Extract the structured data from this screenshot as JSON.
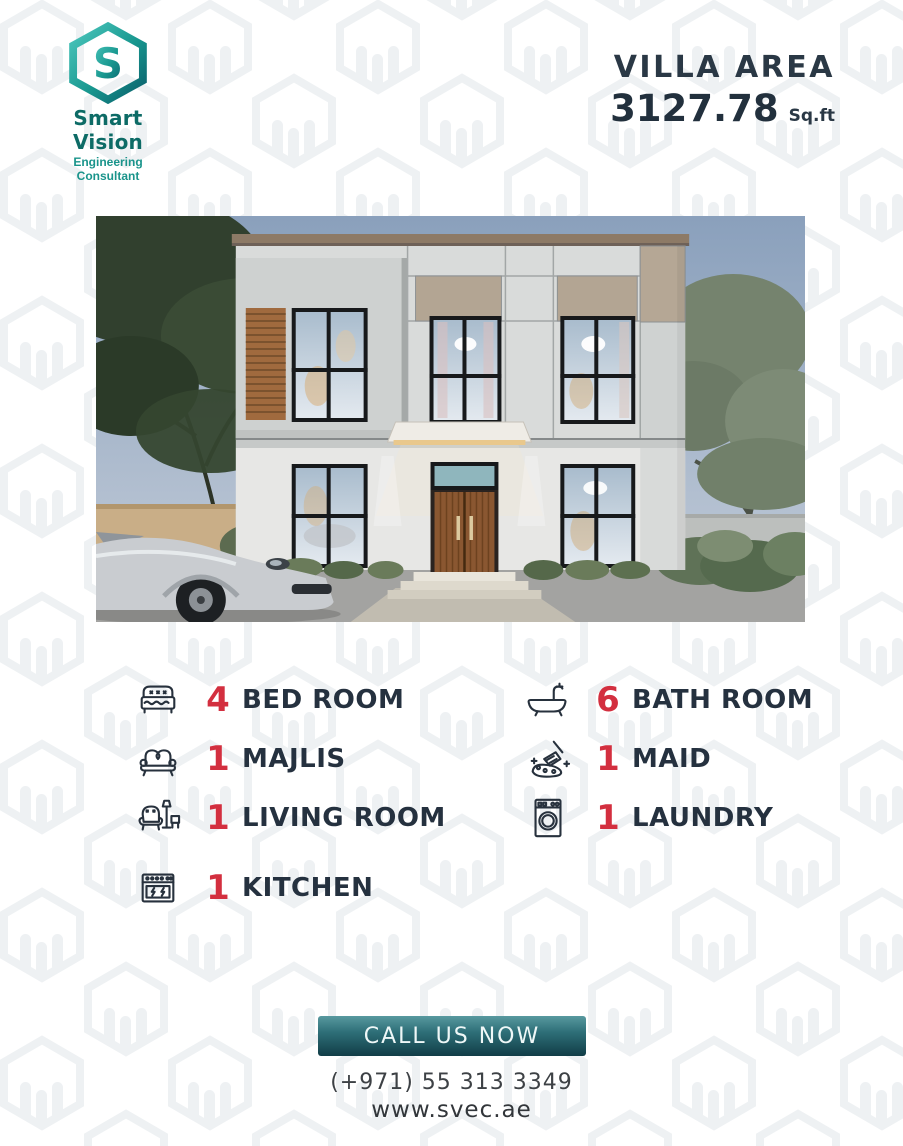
{
  "brand": {
    "name": "Smart Vision",
    "tagline": "Engineering Consultant",
    "logo_icon": "hexagon-s-logo",
    "name_color": "#0d6b66",
    "tagline_color": "#1a948b"
  },
  "villa_area": {
    "label": "VILLA AREA",
    "value": "3127.78",
    "unit": "Sq.ft"
  },
  "hero_image": {
    "alt": "Modern two-story villa render with trees, silver sports car, wooden entrance door"
  },
  "features": {
    "count_color": "#d32f3f",
    "label_color": "#25313f",
    "left": [
      {
        "icon": "bed-icon",
        "count": "4",
        "label": "BED ROOM"
      },
      {
        "icon": "sofa-icon",
        "count": "1",
        "label": "MAJLIS"
      },
      {
        "icon": "armchair-icon",
        "count": "1",
        "label": "LIVING ROOM"
      },
      {
        "icon": "stove-icon",
        "count": "1",
        "label": "KITCHEN"
      }
    ],
    "right": [
      {
        "icon": "bathtub-icon",
        "count": "6",
        "label": "BATH ROOM"
      },
      {
        "icon": "cleaning-brush-icon",
        "count": "1",
        "label": "MAID"
      },
      {
        "icon": "washing-machine-icon",
        "count": "1",
        "label": "LAUNDRY"
      }
    ]
  },
  "contact": {
    "cta_label": "CALL US NOW",
    "phone": "(+971) 55 313 3349",
    "website": "www.svec.ae",
    "button_gradient_top": "#58999f",
    "button_gradient_bottom": "#113d47"
  }
}
